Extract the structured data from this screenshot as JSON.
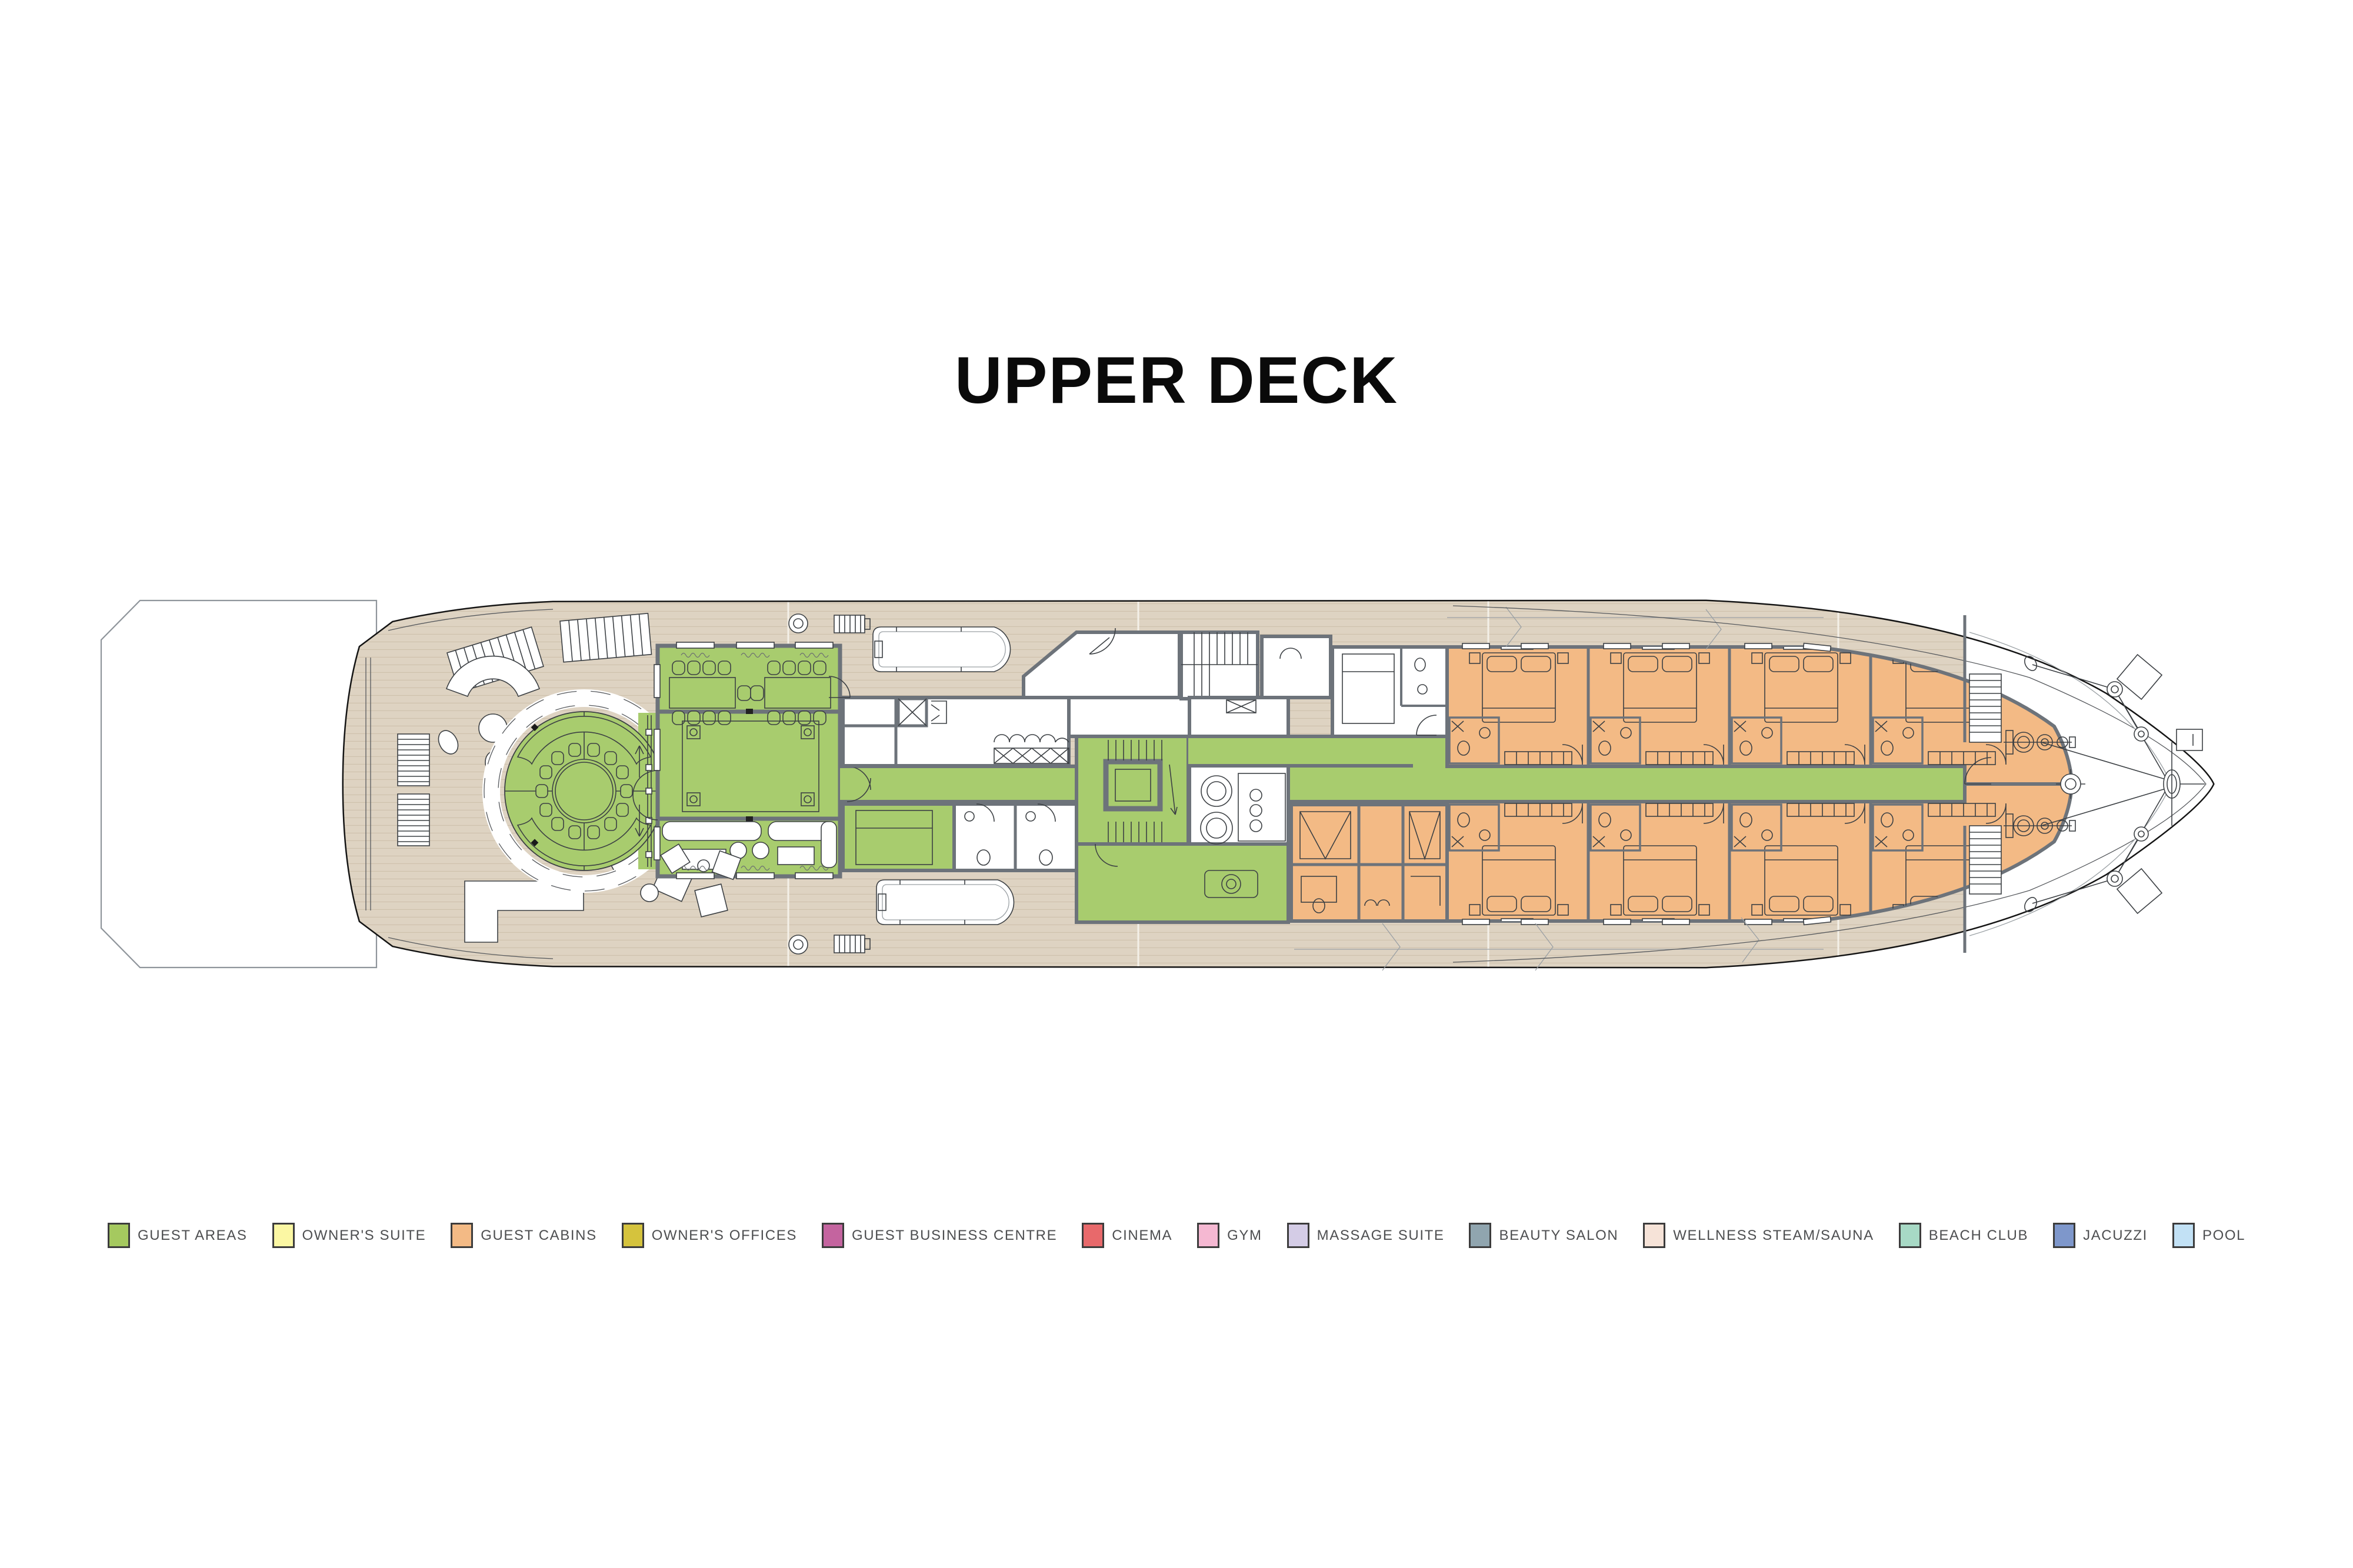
{
  "page": {
    "title": "UPPER DECK",
    "background": "#ffffff"
  },
  "legend": {
    "text_color": "#4d4e50",
    "items": [
      {
        "label": "GUEST AREAS",
        "color": "#a5c95f"
      },
      {
        "label": "OWNER'S SUITE",
        "color": "#fbf7a3"
      },
      {
        "label": "GUEST CABINS",
        "color": "#f3ba85"
      },
      {
        "label": "OWNER'S OFFICES",
        "color": "#d5c33d"
      },
      {
        "label": "GUEST BUSINESS CENTRE",
        "color": "#c4649f"
      },
      {
        "label": "CINEMA",
        "color": "#e8696b"
      },
      {
        "label": "GYM",
        "color": "#f5b8d2"
      },
      {
        "label": "MASSAGE SUITE",
        "color": "#d4cce6"
      },
      {
        "label": "BEAUTY SALON",
        "color": "#90a5af"
      },
      {
        "label": "WELLNESS STEAM/SAUNA",
        "color": "#f6e3d8"
      },
      {
        "label": "BEACH CLUB",
        "color": "#a7d9c5"
      },
      {
        "label": "JACUZZI",
        "color": "#7e97cb"
      },
      {
        "label": "POOL",
        "color": "#c2e1f5"
      }
    ]
  },
  "plan": {
    "colors": {
      "guest_areas_fill": "#a8cc6e",
      "guest_cabins_fill": "#f3ba85",
      "teak_deck": "#ded3c2",
      "walls": "#6d737a",
      "hull_outline": "#141414",
      "foredeck": "#ffffff"
    }
  }
}
